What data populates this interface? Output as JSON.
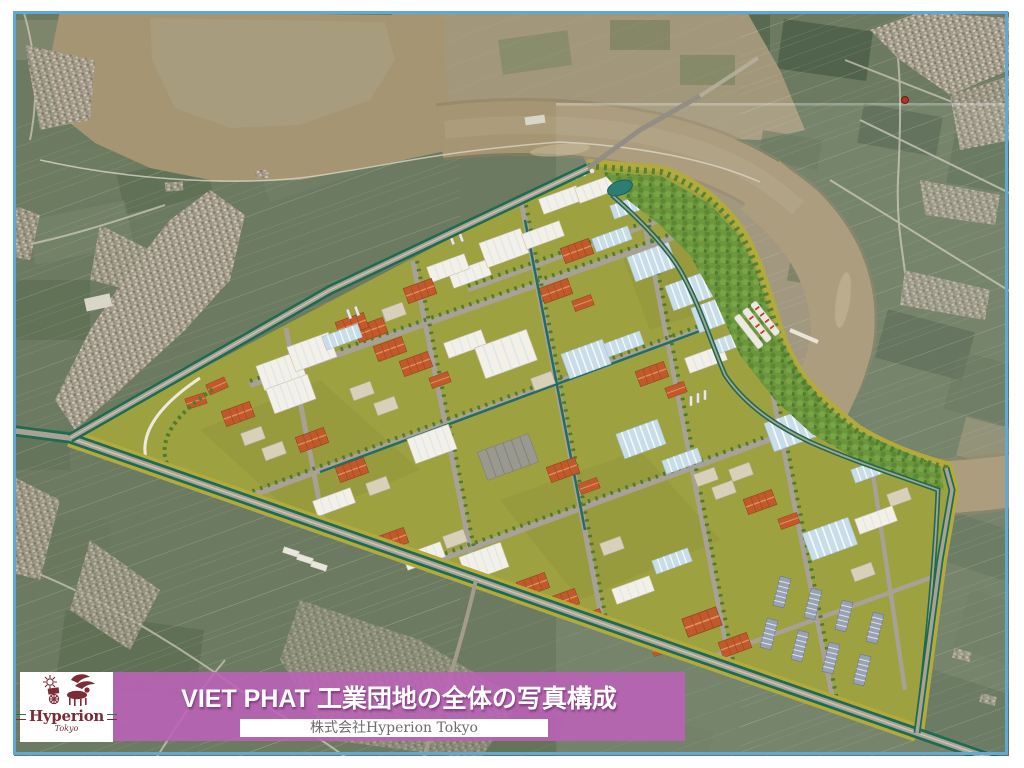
{
  "slide": {
    "title": "VIET PHAT 工業団地の全体の写真構成",
    "company": "株式会社Hyperion Tokyo",
    "logo": {
      "name": "Hyperion",
      "city": "Tokyo"
    }
  },
  "colors": {
    "border_blue": "#5ea9d8",
    "banner_magenta": "#bb5cba",
    "logo_maroon": "#7b2c34",
    "company_gray": "#6d6d6d",
    "river_brown": "#a59573",
    "floodplain_tan": "#a2977a",
    "field_green": "#6b7a60",
    "village_gray": "#a39b8b",
    "park_ground_olive": "#9da13f",
    "park_boundary_olive": "#b3aa3e",
    "forest_green": "#6d963e",
    "road_gray": "#a8a196",
    "median_green": "#1e6b50",
    "warehouse_white": "#f3f0e7",
    "warehouse_blue": "#c9dde9",
    "roof_orange": "#c05a2c"
  }
}
